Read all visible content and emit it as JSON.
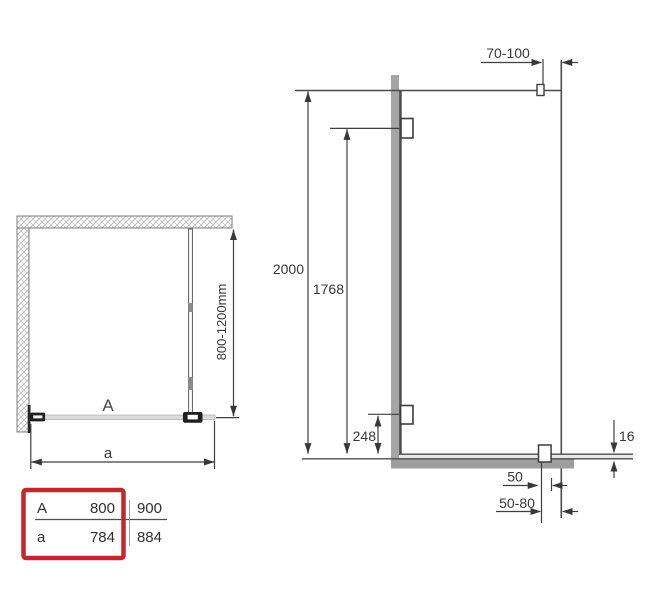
{
  "drawing": {
    "plan": {
      "glass_label": "A",
      "width_label": "a",
      "support_bar_range": "800-1200mm"
    },
    "elevation": {
      "top_offset_range": "70-100",
      "overall_height": "2000",
      "upper_clamp_height": "1768",
      "lower_clamp_offset": "248",
      "floor_profile_thickness": "16",
      "bottom_bracket_width": "50",
      "bottom_offset_range": "50-80"
    },
    "size_table": {
      "rows": [
        {
          "label": "A",
          "values": [
            "800",
            "900"
          ]
        },
        {
          "label": "a",
          "values": [
            "784",
            "884"
          ]
        }
      ],
      "highlight_color": "#c1272d"
    },
    "colors": {
      "line": "#3f3f3f",
      "wall_gray": "#a5a5a5",
      "floor_gray": "#9e9e9e",
      "glass_gray": "#dcdcdc"
    }
  }
}
